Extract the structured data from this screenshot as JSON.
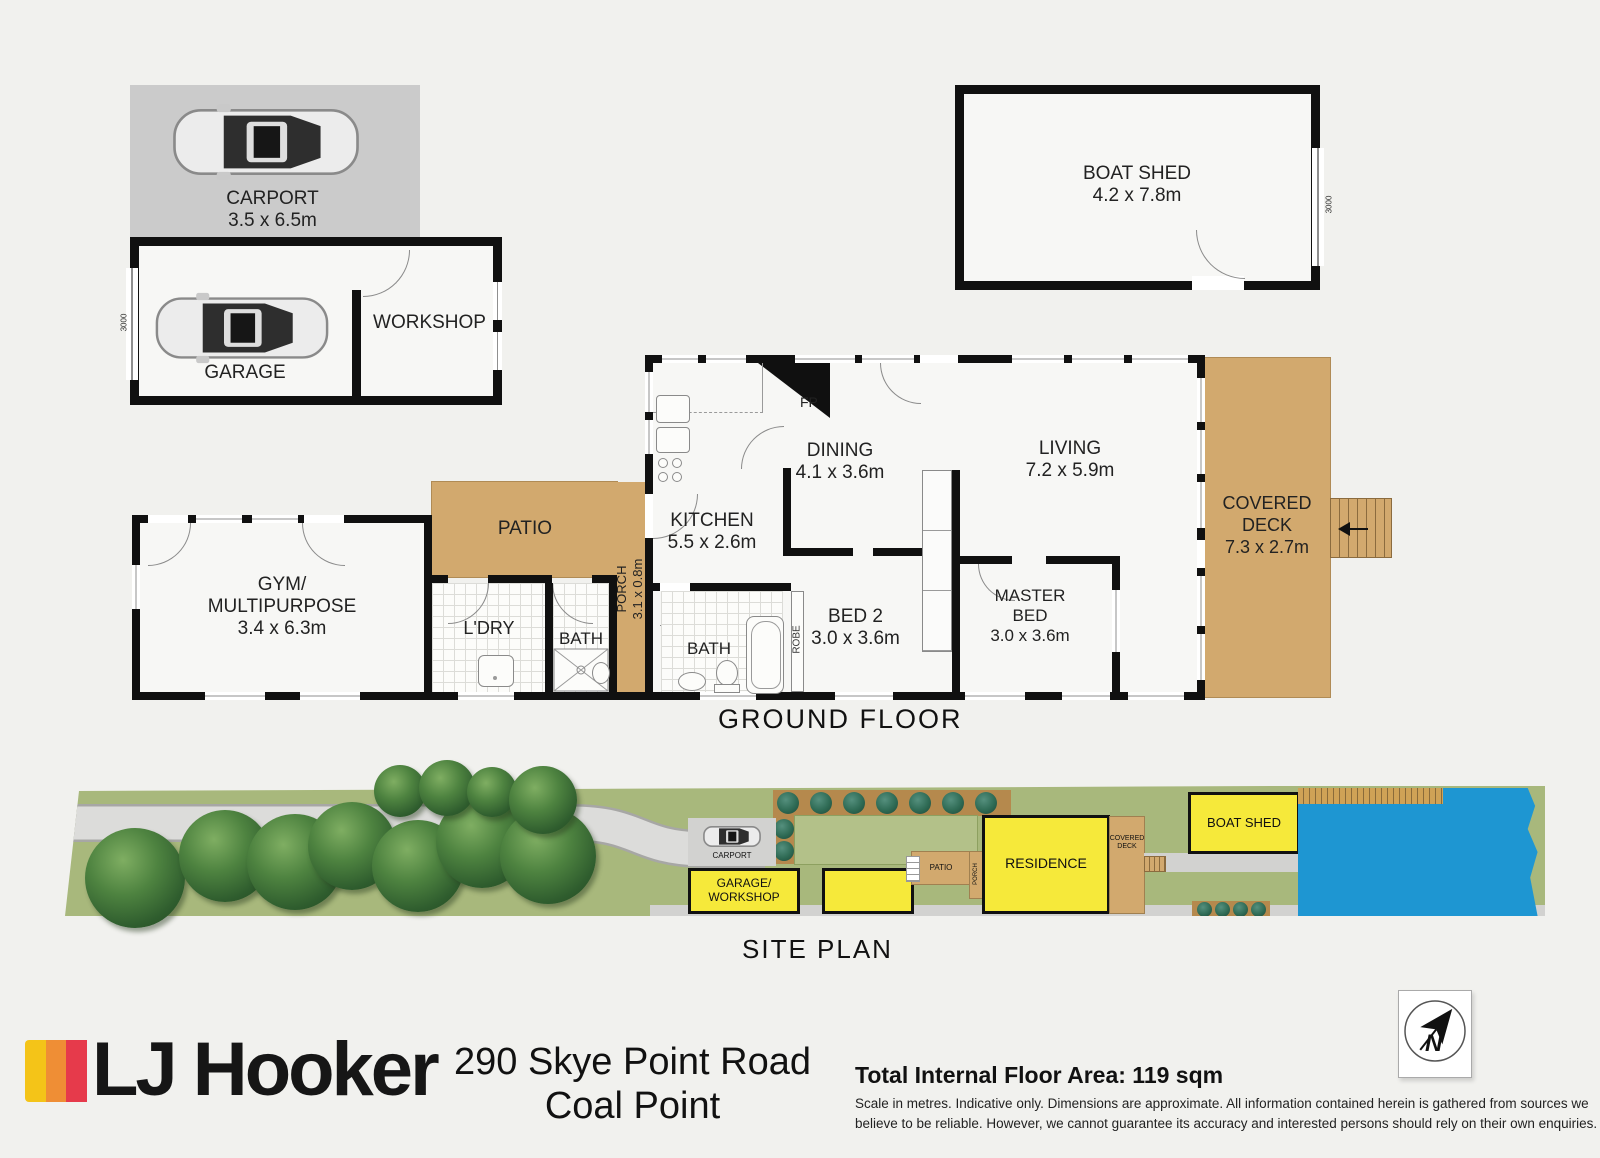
{
  "colors": {
    "background": "#f1f1ee",
    "wall": "#101010",
    "deck_tan": "#d2a96e",
    "site_green": "#a8b87c",
    "lawn_green": "#b3c189",
    "garden_bed": "#b5894d",
    "water_blue": "#1e96d2",
    "building_yellow": "#f6e93a",
    "road_gray": "#dcdcda",
    "carport_gray": "#cbcbcb",
    "brand_yellow": "#f4c418",
    "brand_orange": "#ef8e35",
    "brand_red": "#e63a4b"
  },
  "outbuildings": {
    "carport": {
      "name": "CARPORT",
      "dims": "3.5 x 6.5m"
    },
    "garage": {
      "name": "GARAGE"
    },
    "workshop": {
      "name": "WORKSHOP"
    },
    "garage_door_dim": "3000",
    "boat_shed": {
      "name": "BOAT SHED",
      "dims": "4.2 x 7.8m",
      "door_dim": "3000"
    }
  },
  "ground_floor": {
    "title": "GROUND FLOOR",
    "rooms": {
      "living": {
        "name": "LIVING",
        "dims": "7.2 x 5.9m"
      },
      "dining": {
        "name": "DINING",
        "dims": "4.1 x 3.6m"
      },
      "kitchen": {
        "name": "KITCHEN",
        "dims": "5.5 x 2.6m"
      },
      "bed2": {
        "name": "BED 2",
        "dims": "3.0 x 3.6m"
      },
      "master": {
        "name1": "MASTER",
        "name2": "BED",
        "dims": "3.0 x 3.6m"
      },
      "gym": {
        "name1": "GYM/",
        "name2": "MULTIPURPOSE",
        "dims": "3.4 x 6.3m"
      },
      "covered_deck": {
        "name1": "COVERED",
        "name2": "DECK",
        "dims": "7.3 x 2.7m"
      },
      "patio": {
        "name": "PATIO"
      },
      "porch": {
        "name": "PORCH",
        "dims": "3.1 x 0.8m"
      },
      "laundry": {
        "name": "L'DRY"
      },
      "bath1": {
        "name": "BATH"
      },
      "bath2": {
        "name": "BATH"
      },
      "robe": {
        "name": "ROBE"
      },
      "fireplace": {
        "name": "FP"
      }
    }
  },
  "site_plan": {
    "title": "SITE PLAN",
    "labels": {
      "carport": "CARPORT",
      "garage1": "GARAGE/",
      "garage2": "WORKSHOP",
      "patio": "PATIO",
      "porch": "PORCH",
      "residence": "RESIDENCE",
      "deck1": "COVERED",
      "deck2": "DECK",
      "boat_shed": "BOAT SHED"
    }
  },
  "footer": {
    "brand": "LJ Hooker",
    "address1": "290 Skye Point Road",
    "address2": "Coal Point",
    "floor_area": "Total Internal Floor Area: 119 sqm",
    "disclaimer1": "Scale in metres. Indicative only. Dimensions are approximate. All information contained herein is gathered from sources we",
    "disclaimer2": "believe to be reliable. However, we cannot guarantee its accuracy and interested persons should rely on their own enquiries.",
    "compass_n": "N"
  }
}
